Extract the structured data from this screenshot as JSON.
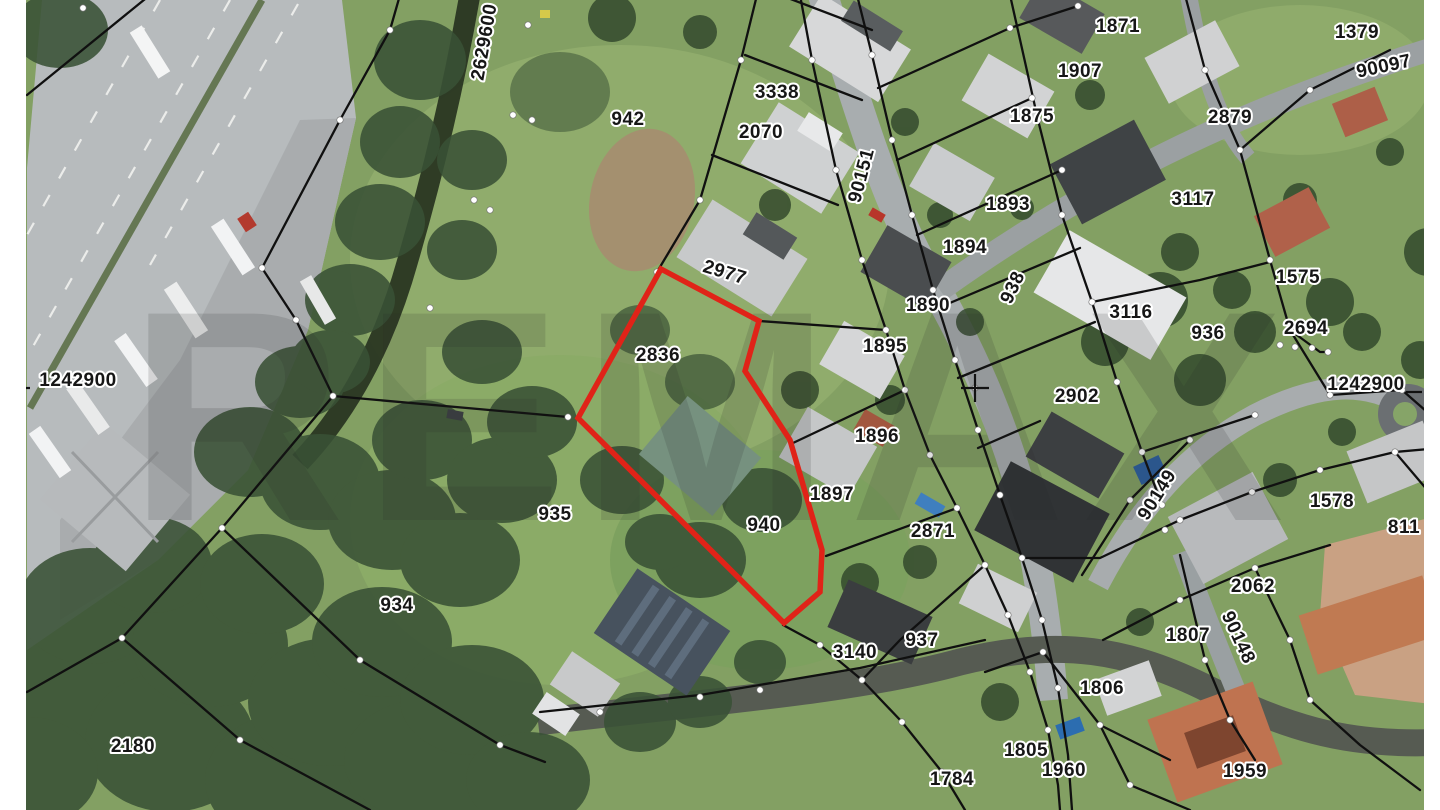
{
  "map": {
    "type": "cadastral-parcel-map-over-aerial-photo",
    "watermark": "REMAX",
    "grid": {
      "horizontal_coordinate": "1242900",
      "vertical_coordinate": "2629600"
    },
    "highlighted_parcel": {
      "numbers": [
        "2836",
        "940"
      ],
      "outline_color": "#e02318",
      "points": [
        [
          661,
          269
        ],
        [
          759,
          321
        ],
        [
          745,
          371
        ],
        [
          790,
          440
        ],
        [
          822,
          550
        ],
        [
          820,
          592
        ],
        [
          784,
          623
        ],
        [
          578,
          418
        ]
      ]
    },
    "road_parcel_numbers": [
      "90151",
      "938",
      "90097",
      "90148",
      "90149"
    ],
    "labels": [
      {
        "t": "942",
        "x": 628,
        "y": 125
      },
      {
        "t": "3338",
        "x": 777,
        "y": 98
      },
      {
        "t": "2070",
        "x": 761,
        "y": 138
      },
      {
        "t": "2977",
        "x": 723,
        "y": 278,
        "r": 17
      },
      {
        "t": "90151",
        "x": 867,
        "y": 177,
        "r": -75
      },
      {
        "t": "2836",
        "x": 658,
        "y": 361
      },
      {
        "t": "1871",
        "x": 1118,
        "y": 32
      },
      {
        "t": "1907",
        "x": 1080,
        "y": 77
      },
      {
        "t": "1875",
        "x": 1032,
        "y": 122
      },
      {
        "t": "1893",
        "x": 1008,
        "y": 210
      },
      {
        "t": "1894",
        "x": 965,
        "y": 253
      },
      {
        "t": "1890",
        "x": 928,
        "y": 311
      },
      {
        "t": "1895",
        "x": 885,
        "y": 352
      },
      {
        "t": "938",
        "x": 1018,
        "y": 290,
        "r": -65
      },
      {
        "t": "1896",
        "x": 877,
        "y": 442
      },
      {
        "t": "1897",
        "x": 832,
        "y": 500
      },
      {
        "t": "2902",
        "x": 1077,
        "y": 402
      },
      {
        "t": "3117",
        "x": 1193,
        "y": 205
      },
      {
        "t": "2879",
        "x": 1230,
        "y": 123
      },
      {
        "t": "1379",
        "x": 1357,
        "y": 38
      },
      {
        "t": "90097",
        "x": 1385,
        "y": 72,
        "r": -12
      },
      {
        "t": "3116",
        "x": 1131,
        "y": 318
      },
      {
        "t": "936",
        "x": 1208,
        "y": 339
      },
      {
        "t": "1575",
        "x": 1298,
        "y": 283
      },
      {
        "t": "2694",
        "x": 1306,
        "y": 334
      },
      {
        "t": "1242900",
        "x": 78,
        "y": 386
      },
      {
        "t": "1242900",
        "x": 1366,
        "y": 390
      },
      {
        "t": "2629600",
        "x": 490,
        "y": 43,
        "r": -80
      },
      {
        "t": "935",
        "x": 555,
        "y": 520
      },
      {
        "t": "940",
        "x": 764,
        "y": 531
      },
      {
        "t": "2871",
        "x": 933,
        "y": 537
      },
      {
        "t": "934",
        "x": 397,
        "y": 611
      },
      {
        "t": "2180",
        "x": 133,
        "y": 752
      },
      {
        "t": "3140",
        "x": 855,
        "y": 658
      },
      {
        "t": "937",
        "x": 922,
        "y": 646
      },
      {
        "t": "90149",
        "x": 1162,
        "y": 498,
        "r": -58
      },
      {
        "t": "1578",
        "x": 1332,
        "y": 507
      },
      {
        "t": "811",
        "x": 1404,
        "y": 533
      },
      {
        "t": "2062",
        "x": 1253,
        "y": 592
      },
      {
        "t": "1807",
        "x": 1188,
        "y": 641
      },
      {
        "t": "90148",
        "x": 1233,
        "y": 640,
        "r": 65
      },
      {
        "t": "1806",
        "x": 1102,
        "y": 694
      },
      {
        "t": "1805",
        "x": 1026,
        "y": 756
      },
      {
        "t": "1960",
        "x": 1064,
        "y": 776
      },
      {
        "t": "1784",
        "x": 952,
        "y": 785
      },
      {
        "t": "1959",
        "x": 1245,
        "y": 777
      }
    ]
  }
}
